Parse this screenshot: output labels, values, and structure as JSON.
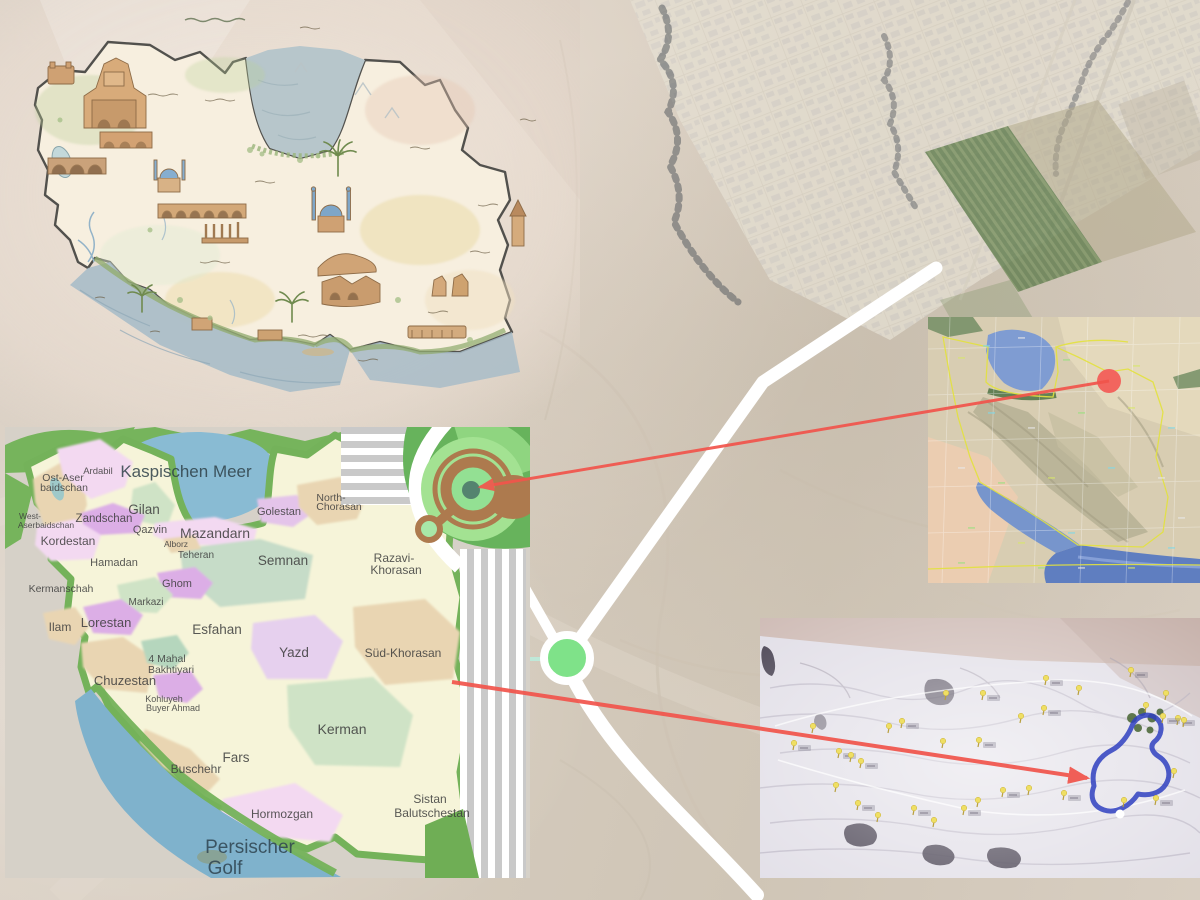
{
  "page": {
    "title": "Iran site location composite",
    "width": 1200,
    "height": 900
  },
  "colors": {
    "background_desert": "#d6ccbe",
    "road_white": "#ffffff",
    "roundabout_green": "#7fe289",
    "connector_red": "#f1544b",
    "magnifier_brown": "#ad7a4e",
    "magnifier_green": "#a3e292",
    "magnifier_center_teal": "#54836f",
    "provinces_sea_blue": "#89bbd3",
    "province_border_green": "#74b25a",
    "satellite_marker_red": "#f2655e",
    "site_outline_blue": "#2f3fc0",
    "site_pin_yellow": "#efdf63"
  },
  "background_map": {
    "description": "faded aerial satellite view of a desert town grid with agricultural strips, a white road junction and a green roundabout marker",
    "roundabout_marker": {
      "x": 567,
      "y": 658,
      "radius": 23
    }
  },
  "pictorial_map": {
    "description": "hand-illustrated watercolor map of Iran with historic monuments, Caspian Sea at top, Persian Gulf at bottom, illegible Persian script captions"
  },
  "provinces_map": {
    "description": "political map of Iranian provinces with German labels; decorative striped corner with magnifier graphic",
    "labels": [
      {
        "t": "Kaspischen Meer",
        "x": 181,
        "y": 50,
        "s": 17,
        "c": "#2f4149"
      },
      {
        "t": "Ardabil",
        "x": 93,
        "y": 47,
        "s": 9.5
      },
      {
        "t": "Ost-Aser",
        "x": 58,
        "y": 54,
        "s": 10.5
      },
      {
        "t": "baidschan",
        "x": 59,
        "y": 64,
        "s": 10.5
      },
      {
        "t": "West-",
        "x": 25,
        "y": 92,
        "s": 8.5
      },
      {
        "t": "Aserbaidschan",
        "x": 41,
        "y": 101,
        "s": 8.5
      },
      {
        "t": "Zandschan",
        "x": 99,
        "y": 95,
        "s": 11.5
      },
      {
        "t": "Gilan",
        "x": 139,
        "y": 87,
        "s": 13.5
      },
      {
        "t": "Qazvin",
        "x": 145,
        "y": 106,
        "s": 11
      },
      {
        "t": "Mazandarn",
        "x": 210,
        "y": 111,
        "s": 14
      },
      {
        "t": "Alborz",
        "x": 171,
        "y": 120,
        "s": 8.5
      },
      {
        "t": "Teheran",
        "x": 191,
        "y": 131,
        "s": 10
      },
      {
        "t": "Golestan",
        "x": 274,
        "y": 88,
        "s": 11
      },
      {
        "t": "North-",
        "x": 326,
        "y": 74,
        "s": 10.5
      },
      {
        "t": "Chorasan",
        "x": 334,
        "y": 83,
        "s": 10.5
      },
      {
        "t": "Kordestan",
        "x": 63,
        "y": 118,
        "s": 12
      },
      {
        "t": "Hamadan",
        "x": 109,
        "y": 139,
        "s": 11
      },
      {
        "t": "Semnan",
        "x": 278,
        "y": 138,
        "s": 13.5
      },
      {
        "t": "Razavi-",
        "x": 389,
        "y": 135,
        "s": 12
      },
      {
        "t": "Khorasan",
        "x": 391,
        "y": 147,
        "s": 12
      },
      {
        "t": "Kermanschah",
        "x": 56,
        "y": 165,
        "s": 10.5
      },
      {
        "t": "Ghom",
        "x": 172,
        "y": 160,
        "s": 11
      },
      {
        "t": "Markazi",
        "x": 141,
        "y": 178,
        "s": 10
      },
      {
        "t": "Ilam",
        "x": 55,
        "y": 204,
        "s": 12
      },
      {
        "t": "Lorestan",
        "x": 101,
        "y": 200,
        "s": 13
      },
      {
        "t": "Esfahan",
        "x": 212,
        "y": 207,
        "s": 13.5
      },
      {
        "t": "Yazd",
        "x": 289,
        "y": 230,
        "s": 13.5
      },
      {
        "t": "Süd-Khorasan",
        "x": 398,
        "y": 230,
        "s": 12
      },
      {
        "t": "4 Mahal",
        "x": 162,
        "y": 235,
        "s": 10.5
      },
      {
        "t": "Bakhtiyari",
        "x": 166,
        "y": 246,
        "s": 10.5
      },
      {
        "t": "Chuzestan",
        "x": 120,
        "y": 258,
        "s": 13
      },
      {
        "t": "Kohluyeh",
        "x": 159,
        "y": 275,
        "s": 9
      },
      {
        "t": "Buyer Ahmad",
        "x": 168,
        "y": 284,
        "s": 9
      },
      {
        "t": "Fars",
        "x": 231,
        "y": 335,
        "s": 13.5
      },
      {
        "t": "Buschehr",
        "x": 191,
        "y": 346,
        "s": 12
      },
      {
        "t": "Kerman",
        "x": 337,
        "y": 307,
        "s": 14
      },
      {
        "t": "Hormozgan",
        "x": 277,
        "y": 391,
        "s": 12
      },
      {
        "t": "Sistan",
        "x": 425,
        "y": 376,
        "s": 12
      },
      {
        "t": "Balutschestan",
        "x": 427,
        "y": 390,
        "s": 12
      },
      {
        "t": "Persischer",
        "x": 245,
        "y": 426,
        "s": 19,
        "c": "#2f4450"
      },
      {
        "t": "Golf",
        "x": 220,
        "y": 447,
        "s": 19,
        "c": "#2f4450"
      }
    ]
  },
  "satellite_inset": {
    "description": "small satellite map of Iran (Caspian Sea top, Persian Gulf bottom, yellow borders, graticule) with red location dot in Razavi-Khorasan",
    "marker": {
      "x": 181,
      "y": 64,
      "radius": 12
    },
    "labels_illegible": true
  },
  "site_inset": {
    "description": "washed-out aerial survey photo with yellow pushpin markers, small gray label tags, green grove patch and a blue outlined site boundary",
    "pins": [
      [
        33,
        132
      ],
      [
        52,
        115
      ],
      [
        78,
        140
      ],
      [
        90,
        144
      ],
      [
        100,
        150
      ],
      [
        128,
        115
      ],
      [
        141,
        110
      ],
      [
        182,
        130
      ],
      [
        218,
        129
      ],
      [
        185,
        82
      ],
      [
        222,
        82
      ],
      [
        260,
        105
      ],
      [
        285,
        67
      ],
      [
        318,
        77
      ],
      [
        283,
        97
      ],
      [
        75,
        174
      ],
      [
        97,
        192
      ],
      [
        117,
        204
      ],
      [
        153,
        197
      ],
      [
        173,
        209
      ],
      [
        203,
        197
      ],
      [
        217,
        189
      ],
      [
        242,
        179
      ],
      [
        268,
        177
      ],
      [
        303,
        182
      ],
      [
        363,
        189
      ],
      [
        395,
        187
      ],
      [
        413,
        160
      ],
      [
        417,
        107
      ],
      [
        385,
        94
      ],
      [
        402,
        105
      ],
      [
        423,
        109
      ],
      [
        370,
        59
      ],
      [
        405,
        82
      ]
    ],
    "labels_illegible": true
  },
  "connectors": [
    {
      "id": "to-magnifier",
      "from": "satellite-inset-red-dot",
      "to": "provinces-magnifier-center",
      "x1": 1109,
      "y1": 381,
      "x2": 480,
      "y2": 487,
      "w": 3
    },
    {
      "id": "to-site",
      "from": "provinces-map-east-edge",
      "to": "site-outline",
      "x1": 452,
      "y1": 682,
      "x2": 1087,
      "y2": 778,
      "w": 4
    }
  ]
}
